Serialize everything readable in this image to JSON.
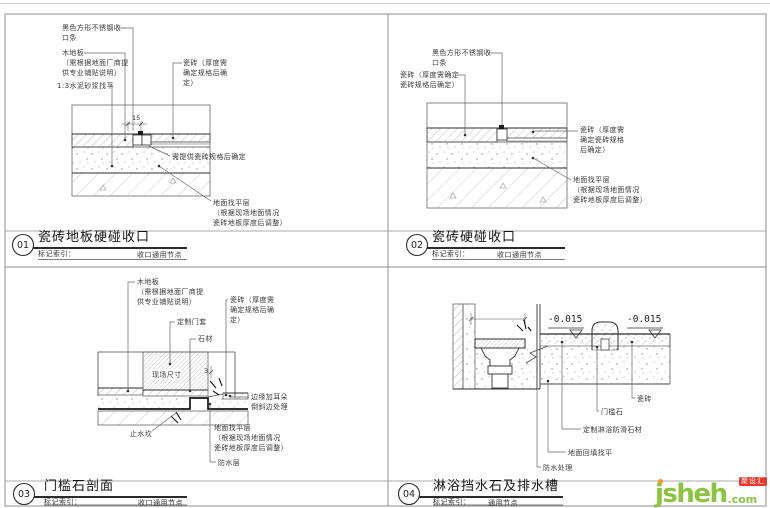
{
  "colors": {
    "logo_green": "#8bc53f",
    "logo_orange": "#f7941e",
    "logo_red": "#e8372c"
  },
  "titles": {
    "p1": {
      "no": "01",
      "title": "瓷砖地板硬碰收口",
      "index_label": "标记索引：",
      "index_value": "收口通用节点"
    },
    "p2": {
      "no": "02",
      "title": "瓷砖硬碰收口",
      "index_label": "标记索引：",
      "index_value": "收口通用节点"
    },
    "p3": {
      "no": "03",
      "title": "门槛石剖面",
      "index_label": "标记索引：",
      "index_value": "收口通用节点"
    },
    "p4": {
      "no": "04",
      "title": "淋浴挡水石及排水槽",
      "index_label": "标记索引：",
      "index_value": "通用节点"
    }
  },
  "p1": {
    "steel": [
      "黑色方形不锈钢收",
      "口条"
    ],
    "wood": [
      "木地板",
      "（需根据地面厂商提",
      "供专业铺贴说明）"
    ],
    "mortar": "1:3水泥砂浆找平",
    "tile": [
      "瓷砖（厚度需",
      "确定规格后确",
      "定）"
    ],
    "spec": "需提供瓷砖规格后确定",
    "leveling": [
      "地面找平层",
      "（根据现场地面情况",
      "瓷砖地板厚度后调整）"
    ],
    "dim": "15"
  },
  "p2": {
    "steel": [
      "黑色方形不锈钢收",
      "口条"
    ],
    "tile_left": [
      "瓷砖（厚度需确定",
      "瓷砖规格后确定）"
    ],
    "tile_right": [
      "瓷砖（厚度需",
      "确定瓷砖规格",
      "后确定）"
    ],
    "leveling": [
      "地面找平层",
      "（根据现场地面情况",
      "瓷砖地板厚度后调整）"
    ]
  },
  "p3": {
    "wood": [
      "木地板",
      "（需根据地面厂商提",
      "供专业铺贴说明）"
    ],
    "door": "定制门套",
    "stone": "石材",
    "tile": [
      "瓷砖（厚度需",
      "确定规格后确",
      "定）"
    ],
    "site": "现场尺寸",
    "edge": [
      "边缘加耳朵",
      "倒斜边处理"
    ],
    "waterstop": "止水坎",
    "leveling": [
      "地面找平层",
      "（根据现场地面情况",
      "瓷砖地板厚度后调整）"
    ],
    "waterproof": "防水层",
    "dim": "3"
  },
  "p4": {
    "elev_left": "-0.015",
    "elev_right": "-0.015",
    "tile": "瓷砖",
    "threshold": "门槛石",
    "shower_stone": "定制淋浴防滑石材",
    "backfill": "地面回填找平",
    "waterproof": "防水处理"
  },
  "logo": {
    "name": "jsheh",
    "tld": ".com",
    "badge": "聚设汇"
  }
}
